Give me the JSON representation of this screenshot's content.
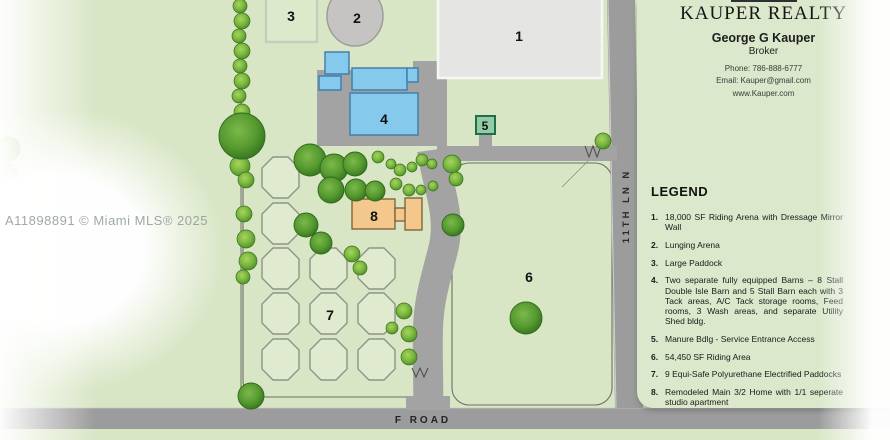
{
  "watermark": "A11898891 © Miami MLS® 2025",
  "broker_card": {
    "title": "KAUPER REALTY",
    "agent": "George G Kauper",
    "role": "Broker",
    "phone": "Phone: 786-888-6777",
    "email": "Email: Kauper@gmail.com",
    "website": "www.Kauper.com"
  },
  "legend": {
    "heading": "LEGEND",
    "items": [
      {
        "num": "1.",
        "text": "18,000 SF Riding Arena with Dressage Mirror Wall"
      },
      {
        "num": "2.",
        "text": "Lunging Arena"
      },
      {
        "num": "3.",
        "text": "Large Paddock"
      },
      {
        "num": "4.",
        "text": "Two separate fully equipped Barns – 8 Stall Double Isle Barn and 5 Stall Barn each with 3 Tack areas, A/C Tack storage rooms, Feed rooms, 3 Wash areas, and separate Utility Shed bldg."
      },
      {
        "num": "5.",
        "text": "Manure Bdlg - Service Entrance Access"
      },
      {
        "num": "6.",
        "text": "54,450 SF Riding Area"
      },
      {
        "num": "7.",
        "text": "9 Equi-Safe Polyurethane Electrified Paddocks"
      },
      {
        "num": "8.",
        "text": "Remodeled Main 3/2 Home with 1/1 seperate studio apartment"
      }
    ]
  },
  "map": {
    "area_labels": {
      "a1": "1",
      "a2": "2",
      "a3": "3",
      "a4": "4",
      "a5": "5",
      "a6": "6",
      "a7": "7",
      "a8": "8"
    },
    "road_labels": {
      "f_road": "F ROAD",
      "lane": "11TH LN N"
    }
  },
  "colors": {
    "map_green": "#d9e6c6",
    "panel_green": "#dbe8cb",
    "road_gray": "#9c9c9c",
    "driveway_gray": "#a3a3a3",
    "arena_gray": "#e5e5e3",
    "barn_blue": "#85c9ec",
    "house_tan": "#f4c88c",
    "shed_green": "#93cba6"
  }
}
